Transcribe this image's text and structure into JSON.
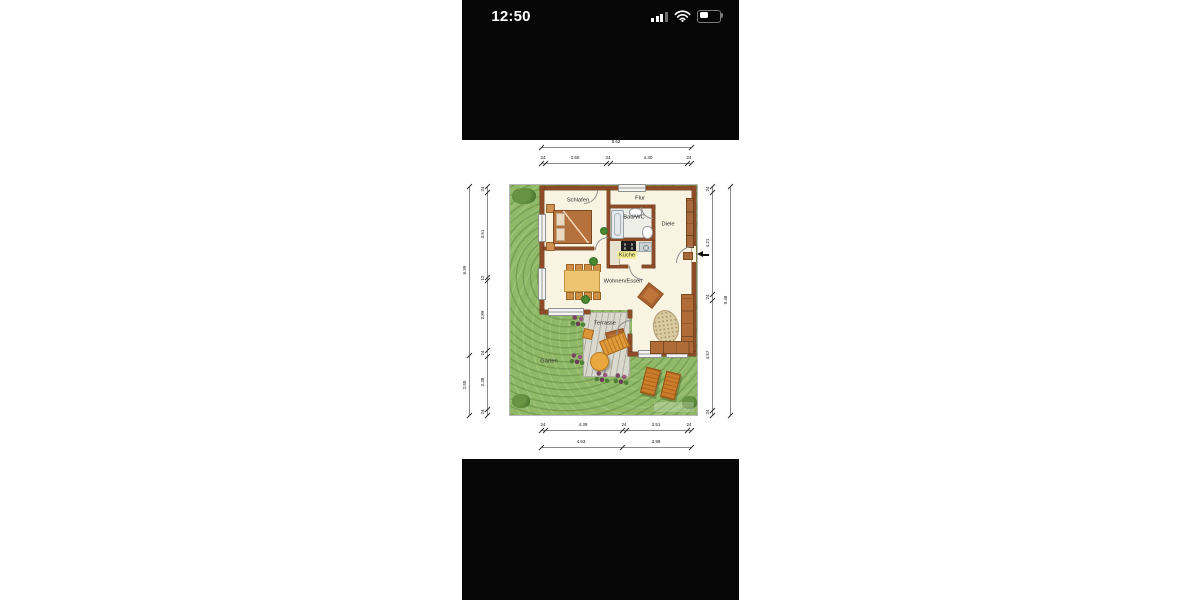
{
  "status_bar": {
    "time": "12:50",
    "icons": [
      "cellular-signal-icon",
      "wifi-icon",
      "battery-icon"
    ],
    "battery_level_percent": 45
  },
  "floor_plan": {
    "rooms": {
      "schlafen": "Schlafen",
      "flur": "Flur",
      "bad": "Bad/WC",
      "diele": "Diele",
      "kueche": "Küche",
      "wohnen": "Wohnen/Essen",
      "terrasse": "Terrasse",
      "garten": "Garten"
    },
    "dims": {
      "top_total": "8.62",
      "top_segments": [
        "24",
        "3.50",
        "24",
        "4.40",
        "24"
      ],
      "left_outer": [
        "6.99",
        "2.50"
      ],
      "left_inner": [
        "24",
        "3.51",
        "12",
        "2.89",
        "24",
        "2.38",
        "24"
      ],
      "right_inner": [
        "24",
        "4.21",
        "24",
        "4.57",
        "24"
      ],
      "right_outer": "9.48",
      "bottom_segments": [
        "24",
        "4.39",
        "24",
        "3.51",
        "24"
      ],
      "bottom_totals": [
        "4.63",
        "3.99"
      ]
    },
    "colors": {
      "wall": "#8d4c27",
      "floor": "#f9f3e1",
      "garden": "#8fb867",
      "deck": "#d8d8cd",
      "bars": "#060606",
      "furniture_accent": "#e09a3a",
      "kitchen_label_bg": "#f3ef8e"
    }
  }
}
